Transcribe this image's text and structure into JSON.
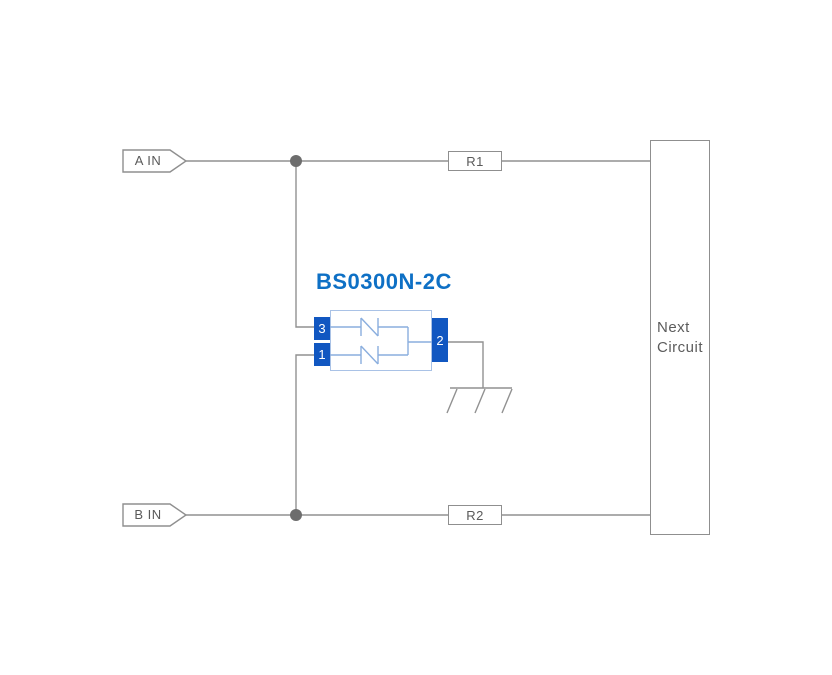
{
  "schematic": {
    "component": {
      "label": "BS0300N-2C",
      "pin_top_left": "3",
      "pin_bottom_left": "1",
      "pin_right": "2"
    },
    "inputs": {
      "a": "A IN",
      "b": "B IN"
    },
    "resistors": {
      "r1": "R1",
      "r2": "R2"
    },
    "next_circuit": {
      "line1": "Next",
      "line2": "Circuit"
    }
  },
  "colors": {
    "background": "#ffffff",
    "wire": "#919191",
    "junction_dot": "#6d6d6d",
    "box_outline": "#8f8f8f",
    "label_text": "#5a5a5a",
    "component_label_blue": "#0e70c5",
    "pin_fill_blue": "#1157c1",
    "pin_text": "#ffffff",
    "component_body_outline": "#a9c2e6",
    "diode_symbol_blue": "#8aaede"
  }
}
